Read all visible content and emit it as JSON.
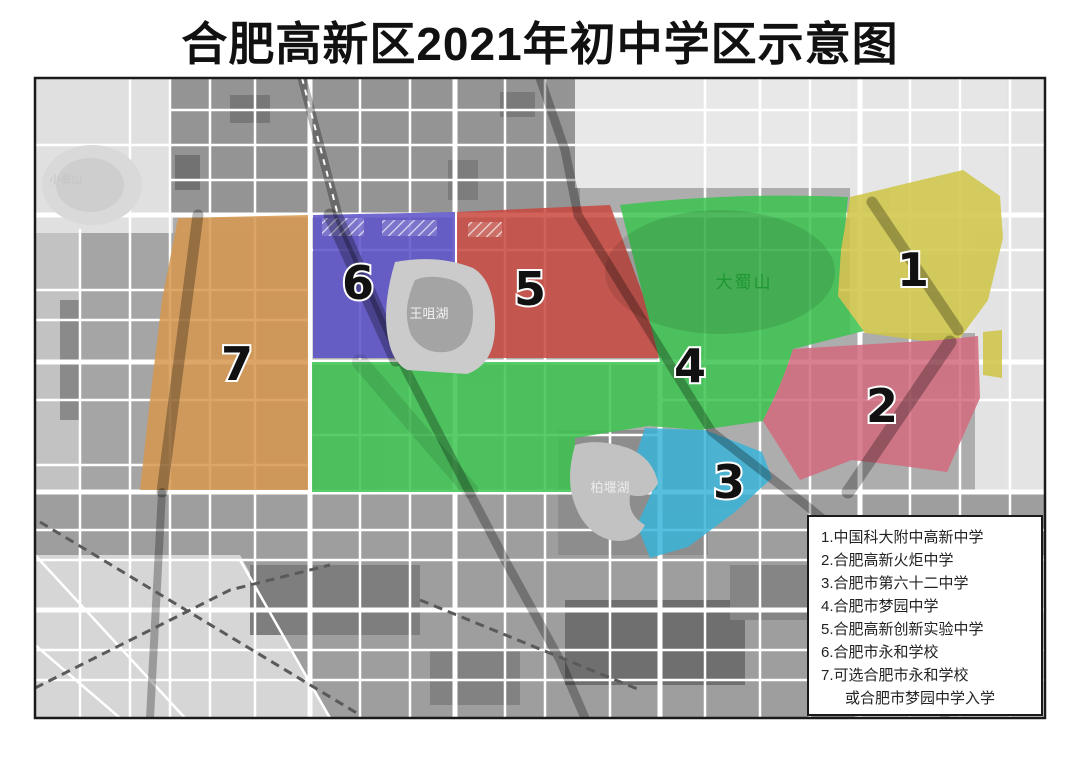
{
  "title": "合肥高新区2021年初中学区示意图",
  "map": {
    "labels": {
      "dashushan": "大蜀山",
      "wangzuihu": "王咀湖",
      "baiyanhu": "柏堰湖",
      "xiaoshushan": "小蜀山"
    },
    "regions": [
      {
        "number": "1",
        "school": "中国科大附中高新中学",
        "color": "#cfc544"
      },
      {
        "number": "2",
        "school": "合肥高新火炬中学",
        "color": "#d26a7e"
      },
      {
        "number": "3",
        "school": "合肥市第六十二中学",
        "color": "#3ab4d8"
      },
      {
        "number": "4",
        "school": "合肥市梦园中学",
        "color": "#3cc44f"
      },
      {
        "number": "5",
        "school": "合肥高新创新实验中学",
        "color": "#c8473e"
      },
      {
        "number": "6",
        "school": "合肥市永和学校",
        "color": "#5950c8"
      },
      {
        "number": "7",
        "school": "可选合肥市永和学校或合肥市梦园中学入学",
        "color": "#d6964d"
      }
    ]
  },
  "legend": {
    "lines": [
      "1.中国科大附中高新中学",
      "2.合肥高新火炬中学",
      "3.合肥市第六十二中学",
      "4.合肥市梦园中学",
      "5.合肥高新创新实验中学",
      "6.合肥市永和学校",
      "7.可选合肥市永和学校",
      "或合肥市梦园中学入学"
    ]
  }
}
